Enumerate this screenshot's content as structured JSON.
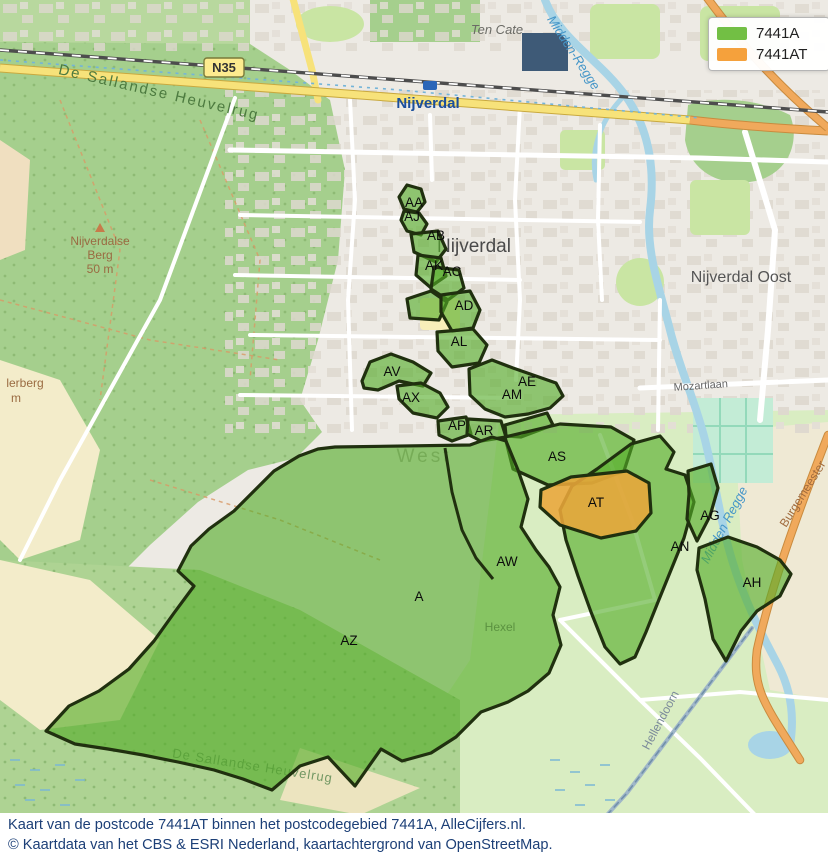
{
  "legend": {
    "items": [
      {
        "label": "7441A",
        "color": "#72bf44"
      },
      {
        "label": "7441AT",
        "color": "#f5a13c"
      }
    ]
  },
  "caption": {
    "line1": "Kaart van de postcode 7441AT binnen het postcodegebied 7441A, AlleCijfers.nl.",
    "line2": "© Kaartdata van het CBS & ESRI Nederland, kaartachtergrond van OpenStreetMap."
  },
  "map": {
    "road_badge": "N35",
    "labels": [
      {
        "text": "De Sallandse Heuvelrug",
        "x": 158,
        "y": 97,
        "rotate": 13,
        "cls": "lbl-green",
        "size": 15
      },
      {
        "text": "Nijverdalse",
        "x": 100,
        "y": 245,
        "cls": "lbl-brown",
        "size": 12
      },
      {
        "text": "Berg",
        "x": 100,
        "y": 259,
        "cls": "lbl-brown",
        "size": 12
      },
      {
        "text": "50 m",
        "x": 100,
        "y": 273,
        "cls": "lbl-brown",
        "size": 12
      },
      {
        "text": "lerberg",
        "x": 25,
        "y": 387,
        "cls": "lbl-brown",
        "size": 12
      },
      {
        "text": "m",
        "x": 16,
        "y": 402,
        "cls": "lbl-brown",
        "size": 12
      },
      {
        "text": "Nijverdal",
        "x": 428,
        "y": 108,
        "cls": "lbl-blue-bold",
        "size": 15
      },
      {
        "text": "Ten Cate",
        "x": 497,
        "y": 34,
        "cls": "lbl-italic",
        "size": 13
      },
      {
        "text": "Midden-Regge",
        "x": 570,
        "y": 55,
        "rotate": 57,
        "cls": "lbl-water",
        "size": 13
      },
      {
        "text": "Nijverdal",
        "x": 474,
        "y": 252,
        "cls": "lbl-city",
        "size": 19
      },
      {
        "text": "Nijverdal Oost",
        "x": 741,
        "y": 282,
        "cls": "lbl-city2",
        "size": 16
      },
      {
        "text": "Mozartlaan",
        "x": 701,
        "y": 389,
        "rotate": -4,
        "cls": "lbl-road",
        "size": 11
      },
      {
        "text": "West",
        "x": 424,
        "y": 462,
        "cls": "lbl-district",
        "size": 19
      },
      {
        "text": "Hexel",
        "x": 500,
        "y": 631,
        "cls": "lbl-road",
        "size": 12
      },
      {
        "text": "Hellendoorn",
        "x": 664,
        "y": 722,
        "rotate": -62,
        "cls": "lbl-road2",
        "size": 12
      },
      {
        "text": "Burgemeester",
        "x": 806,
        "y": 496,
        "rotate": -58,
        "cls": "lbl-road-orange",
        "size": 12
      },
      {
        "text": "Midden Regge",
        "x": 728,
        "y": 527,
        "rotate": -62,
        "cls": "lbl-water",
        "size": 13
      },
      {
        "text": "De Sallandse Heuvelrug",
        "x": 252,
        "y": 770,
        "rotate": 9,
        "cls": "lbl-green2",
        "size": 13
      }
    ],
    "regions": [
      {
        "id": "AA",
        "x": 414,
        "y": 207
      },
      {
        "id": "AJ",
        "x": 412,
        "y": 221
      },
      {
        "id": "AB",
        "x": 436,
        "y": 240
      },
      {
        "id": "AK",
        "x": 434,
        "y": 270
      },
      {
        "id": "AC",
        "x": 452,
        "y": 276
      },
      {
        "id": "AD",
        "x": 464,
        "y": 310
      },
      {
        "id": "AL",
        "x": 459,
        "y": 346
      },
      {
        "id": "AV",
        "x": 392,
        "y": 376
      },
      {
        "id": "AX",
        "x": 411,
        "y": 402
      },
      {
        "id": "AE",
        "x": 527,
        "y": 386
      },
      {
        "id": "AM",
        "x": 512,
        "y": 399
      },
      {
        "id": "AP",
        "x": 457,
        "y": 430
      },
      {
        "id": "AR",
        "x": 484,
        "y": 435
      },
      {
        "id": "AS",
        "x": 557,
        "y": 461
      },
      {
        "id": "AT",
        "x": 596,
        "y": 507
      },
      {
        "id": "AG",
        "x": 710,
        "y": 520
      },
      {
        "id": "AN",
        "x": 680,
        "y": 551
      },
      {
        "id": "AH",
        "x": 752,
        "y": 587
      },
      {
        "id": "AW",
        "x": 507,
        "y": 566
      },
      {
        "id": "A",
        "x": 419,
        "y": 601
      },
      {
        "id": "AZ",
        "x": 349,
        "y": 645
      }
    ]
  },
  "colors": {
    "region_fill": "#54ad28",
    "region_stroke": "#20300f",
    "at_fill": "#e9a63a",
    "water": "#a8d4e6",
    "road_orange": "#f0a95c",
    "road_yellow": "#f7e27a",
    "forest": "#a5cf8d",
    "fields": "#d9edc2",
    "urban": "#edeae4",
    "caption_text": "#1c3f77"
  }
}
